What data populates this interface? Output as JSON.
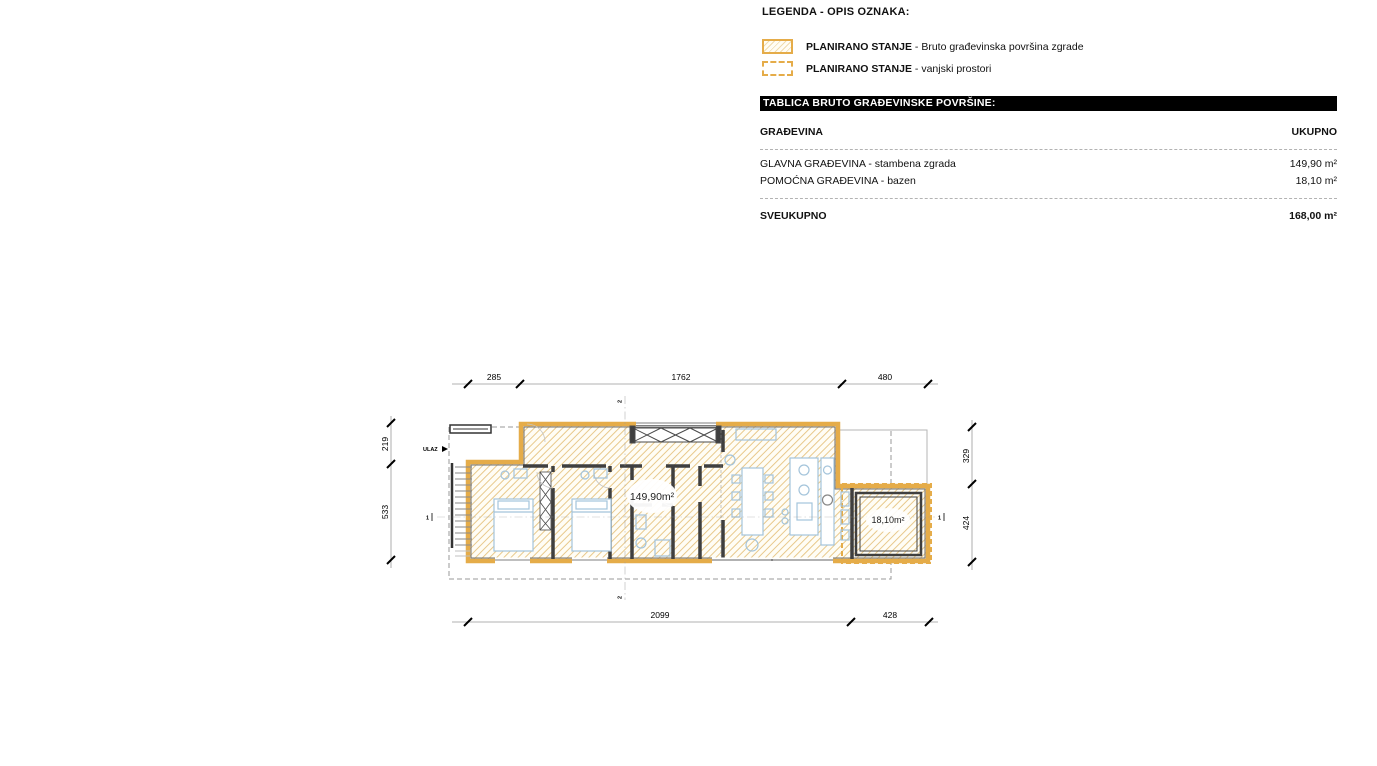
{
  "legend": {
    "title": "LEGENDA - OPIS OZNAKA:",
    "items": [
      {
        "name": "PLANIRANO STANJE",
        "desc": " - Bruto građevinska površina zgrade",
        "swatch": "solid-orange-hatch"
      },
      {
        "name": "PLANIRANO STANJE",
        "desc": " - vanjski prostori",
        "swatch": "dashed-orange"
      }
    ]
  },
  "table": {
    "header_bar": "TABLICA BRUTO GRAĐEVINSKE POVRŠINE:",
    "col_left": "GRAĐEVINA",
    "col_right": "UKUPNO",
    "rows": [
      {
        "label": "GLAVNA GRAĐEVINA - stambena zgrada",
        "value": "149,90 m²"
      },
      {
        "label": "POMOĆNA GRAĐEVINA - bazen",
        "value": "18,10 m²"
      }
    ],
    "total_label": "SVEUKUPNO",
    "total_value": "168,00 m²"
  },
  "plan": {
    "entrance_label": "ULAZ",
    "area_main": "149,90m²",
    "area_pool": "18,10m²",
    "dims": {
      "top": [
        "285",
        "1762",
        "480"
      ],
      "bottom": [
        "2099",
        "428"
      ],
      "left": [
        "219",
        "533"
      ],
      "right": [
        "329",
        "424"
      ]
    },
    "sections": {
      "horizontal": "1",
      "vertical": "2"
    },
    "colors": {
      "outline": "#E5AC49",
      "hatch": "#E8C98C",
      "wall": "#3F3F3F",
      "furniture": "#A4C4DB"
    }
  }
}
